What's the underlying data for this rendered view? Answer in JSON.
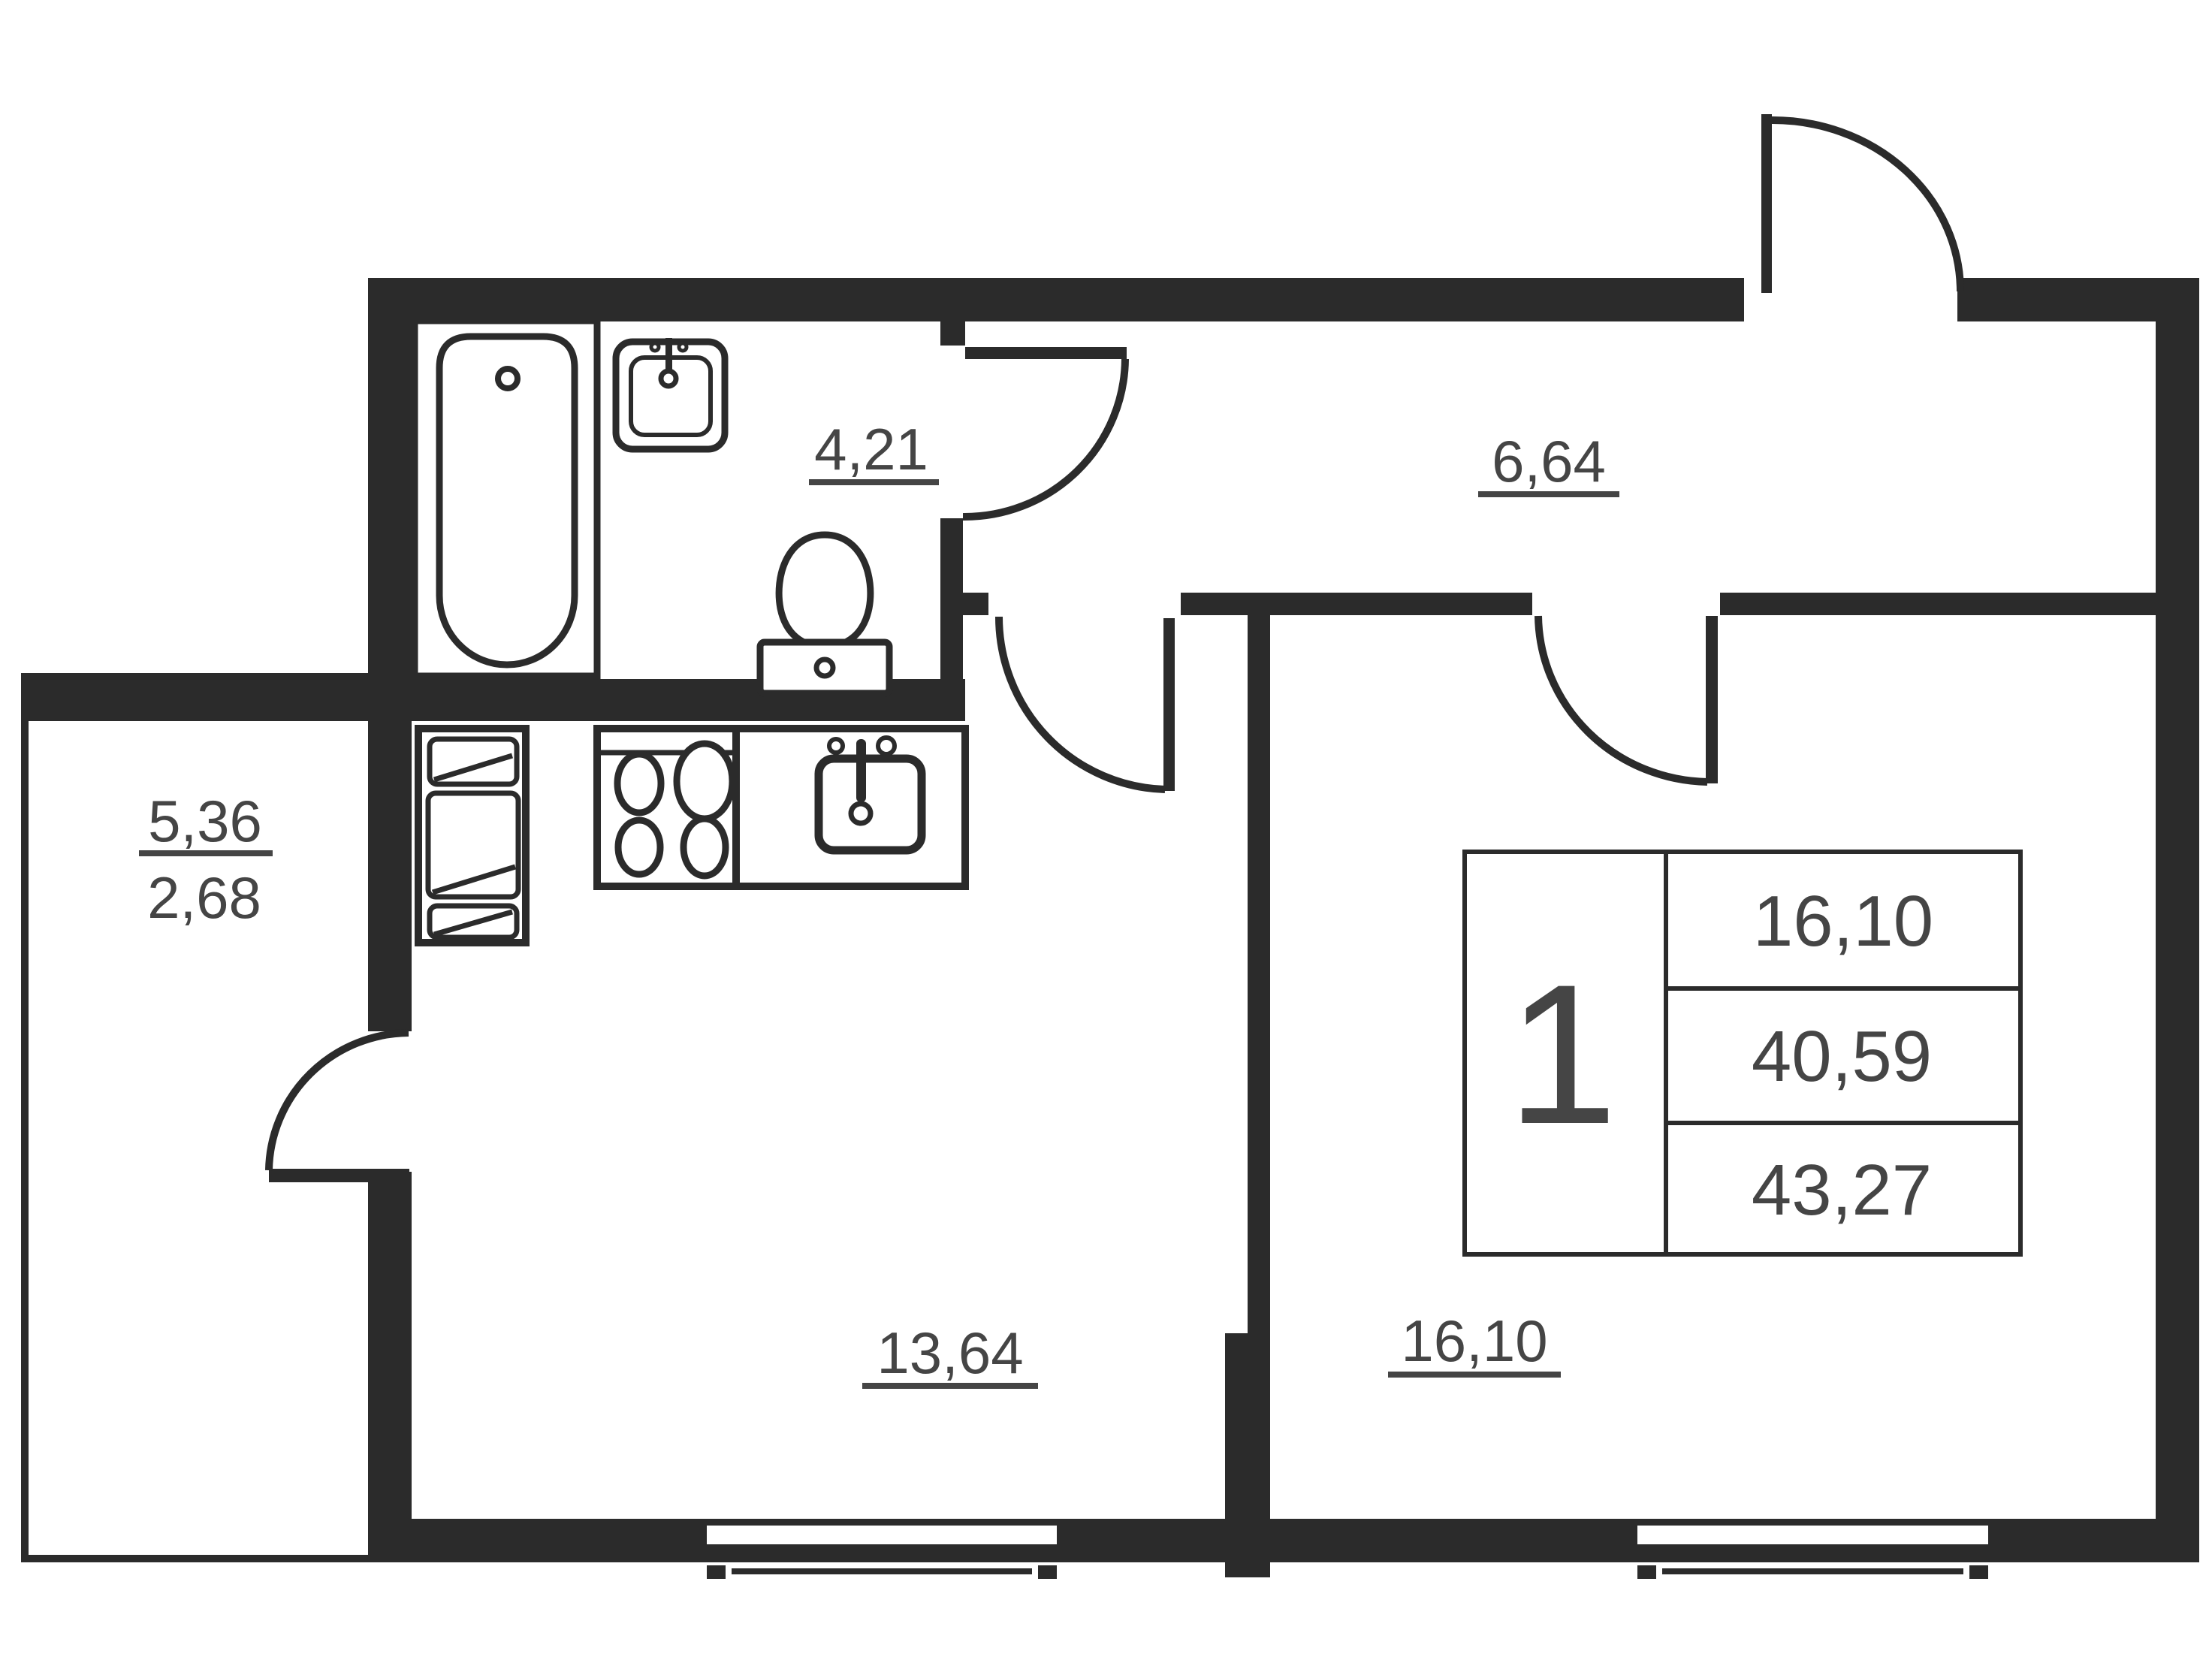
{
  "plan": {
    "type": "apartment-floor-plan",
    "rooms": {
      "bathroom": {
        "area": "4,21"
      },
      "hallway": {
        "area": "6,64"
      },
      "balcony": {
        "area_full": "5,36",
        "area_counted": "2,68"
      },
      "kitchen_living": {
        "area": "13,64"
      },
      "bedroom": {
        "area": "16,10"
      }
    },
    "info_table": {
      "rooms_count": "1",
      "living_area": "16,10",
      "area_without_balcony": "40,59",
      "total_area": "43,27"
    },
    "colors": {
      "wall": "#2b2b2b",
      "text": "#454545",
      "background": "#ffffff"
    }
  }
}
